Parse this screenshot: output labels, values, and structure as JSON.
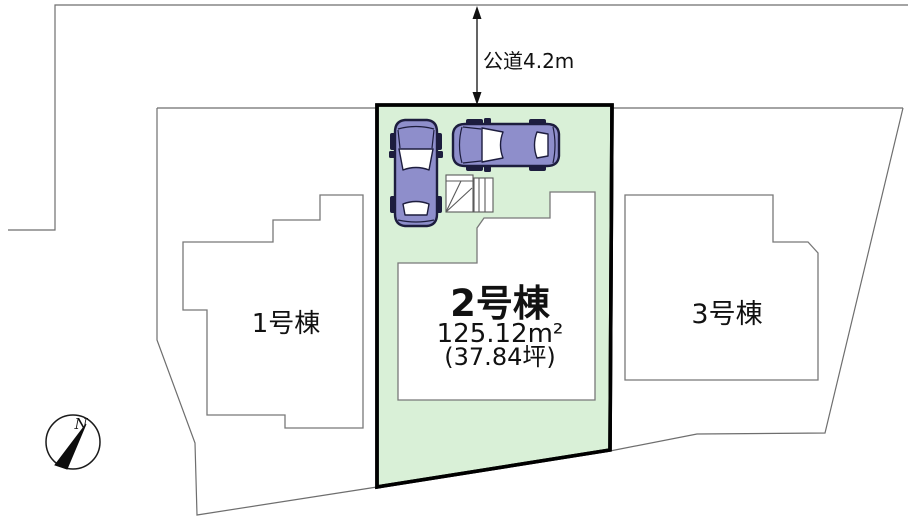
{
  "road": {
    "label": "公道4.2m"
  },
  "plots": {
    "plot1": {
      "label": "1号棟"
    },
    "plot2": {
      "label": "2号棟",
      "area_m2": "125.12m²",
      "area_tsubo": "(37.84坪)"
    },
    "plot3": {
      "label": "3号棟"
    }
  },
  "compass": {
    "north_label": "N"
  },
  "colors": {
    "highlight_fill": "#d9f0d7",
    "highlight_border": "#000000",
    "boundary_line": "#6e6e6e",
    "car_body": "#8e8ecb",
    "text": "#111111"
  }
}
